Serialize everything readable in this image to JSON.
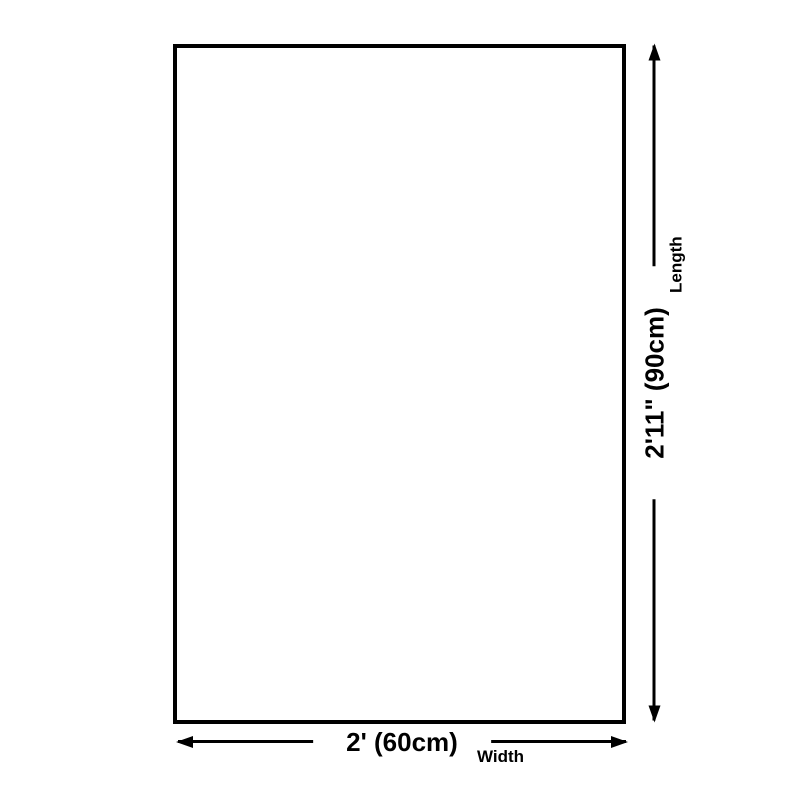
{
  "page": {
    "background_color": "#ffffff",
    "foreground_color": "#000000"
  },
  "diagram": {
    "type": "product-size-diagram",
    "outline": {
      "shape": "rectangle",
      "border_color": "#000000",
      "fill_color": "#ffffff"
    },
    "length": {
      "value": "2'11\" (90cm)",
      "label": "Length"
    },
    "width": {
      "value": "2' (60cm)",
      "label": "Width"
    }
  }
}
